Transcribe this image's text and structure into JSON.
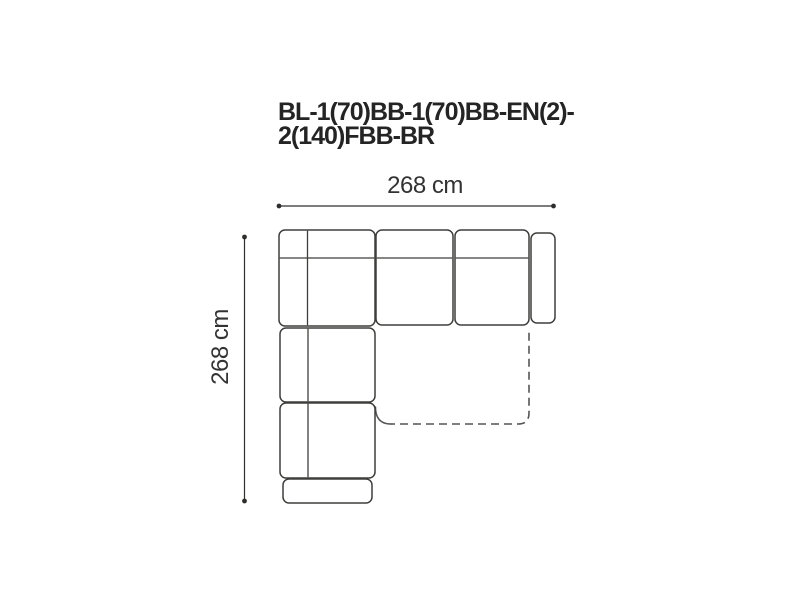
{
  "diagram": {
    "title": "BL-1(70)BB-1(70)BB-EN(2)-2(140)FBB-BR",
    "title_lines": [
      "BL-1(70)BB-1(70)BB-EN(2)-",
      "2(140)FBB-BR"
    ],
    "width_label": "268 cm",
    "depth_label": "268 cm",
    "width_cm": 268,
    "depth_cm": 268,
    "view": "sofa-top-view",
    "parts": [
      "corner-module",
      "seat-module-1(70)",
      "seat-module-1(70)",
      "right-armrest",
      "chaise-seat-module",
      "chaise-seat-module",
      "front-armrest",
      "fold-out-bed-dashed-outline"
    ],
    "colors": {
      "background": "#ffffff",
      "outline": "#3e3e3c",
      "dashed": "#555553",
      "dimension": "#2e2e2c",
      "title_text": "#242424",
      "label_text": "#333333"
    }
  }
}
